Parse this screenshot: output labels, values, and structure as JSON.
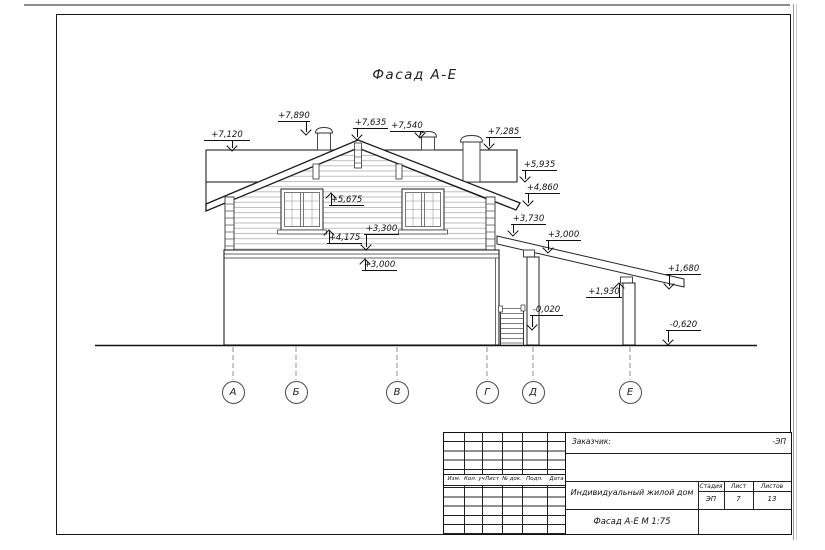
{
  "drawing": {
    "title": "Фасад А-Е",
    "line_color": "#1a1a1a",
    "siding_color": "#adadad"
  },
  "elevation_marks": [
    {
      "value": "+7,120"
    },
    {
      "value": "+7,890"
    },
    {
      "value": "+7,635"
    },
    {
      "value": "+7,540"
    },
    {
      "value": "+7,285"
    },
    {
      "value": "+5,935"
    },
    {
      "value": "+4,860"
    },
    {
      "value": "+5,675"
    },
    {
      "value": "+4,175"
    },
    {
      "value": "+3,300"
    },
    {
      "value": "+3,000"
    },
    {
      "value": "+3,730"
    },
    {
      "value": "+3,000"
    },
    {
      "value": "+1,930"
    },
    {
      "value": "+1,680"
    },
    {
      "value": "-0,020"
    },
    {
      "value": "-0,620"
    }
  ],
  "axes": [
    {
      "label": "А"
    },
    {
      "label": "Б"
    },
    {
      "label": "В"
    },
    {
      "label": "Г"
    },
    {
      "label": "Д"
    },
    {
      "label": "Е"
    }
  ],
  "title_block": {
    "customer_label": "Заказчик:",
    "customer_value": "-ЭП",
    "revision_columns": [
      "Изм.",
      "Кол. уч",
      "Лист",
      "№ док.",
      "Подп.",
      "Дата"
    ],
    "project": "Индивидуальный жилой дом",
    "sheet_title": "Фасад А-Е М 1:75",
    "stage_label": "Стадия",
    "sheet_label": "Лист",
    "sheets_label": "Листов",
    "stage": "ЭП",
    "sheet_number": "7",
    "sheets_total": "13"
  }
}
